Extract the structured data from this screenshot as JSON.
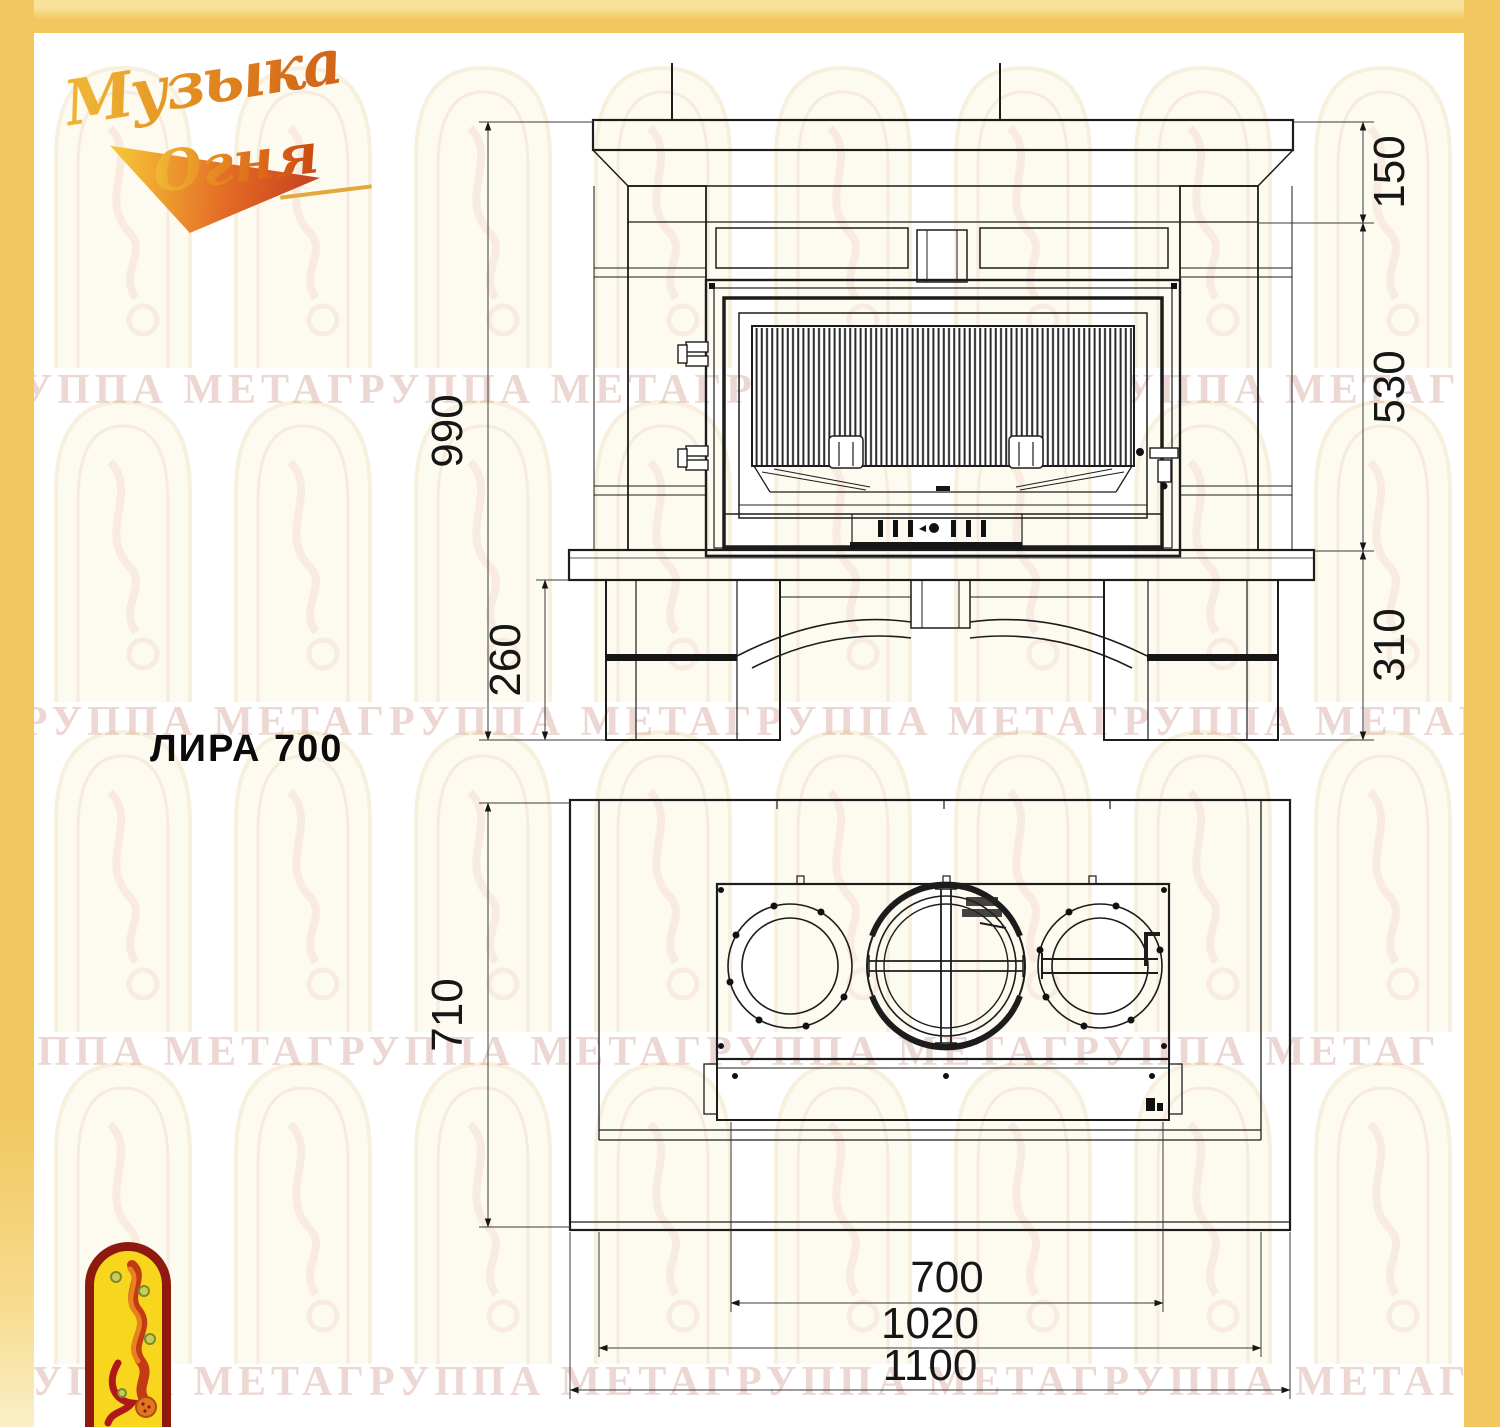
{
  "page": {
    "frame_color": "#F2C75F",
    "background": "#FFFFFF"
  },
  "logo": {
    "word1": "Музыка",
    "word2": "Огня"
  },
  "model": {
    "label": "ЛИРА 700"
  },
  "watermark": {
    "row_text": "ГРУППА МЕТАГРУППА МЕТАГРУППА МЕТАГРУППА МЕТАГРУППА МЕТАГРУППА МЕТА"
  },
  "front_view": {
    "dim_total_height": "990",
    "dim_base_height_left": "260",
    "dim_mantel_top": "150",
    "dim_firebox_height": "530",
    "dim_base_height_right": "310"
  },
  "top_view": {
    "dim_depth": "710",
    "dim_firebox_width": "700",
    "dim_insert_width": "1020",
    "dim_total_width": "1100"
  }
}
